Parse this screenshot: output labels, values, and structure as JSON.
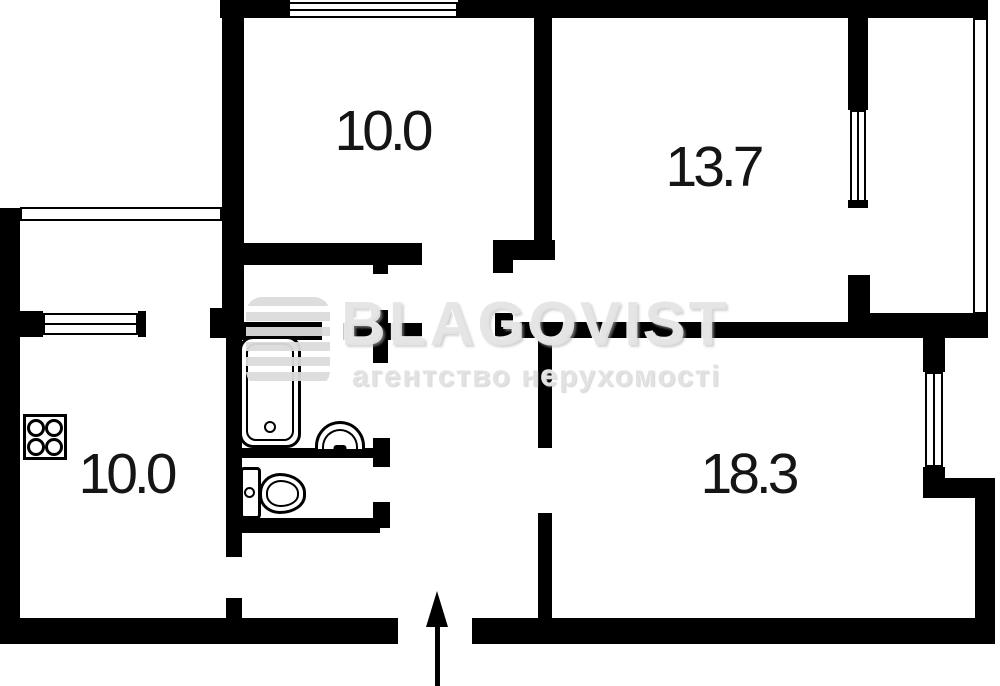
{
  "watermark": {
    "title": "BLAGOVIST",
    "subtitle": "агентство нерухомості",
    "color": "#e4e4e4"
  },
  "room_labels": [
    {
      "id": "top-left-room",
      "text": "10.0",
      "cx": 382,
      "cy": 131
    },
    {
      "id": "top-right-room",
      "text": "13.7",
      "cx": 713,
      "cy": 167
    },
    {
      "id": "kitchen",
      "text": "10.0",
      "cx": 126,
      "cy": 474
    },
    {
      "id": "bottom-right-room",
      "text": "18.3",
      "cx": 748,
      "cy": 474
    }
  ],
  "wall_color": "#000000",
  "walls": [
    {
      "x": 220,
      "y": 0,
      "w": 70,
      "h": 18
    },
    {
      "x": 458,
      "y": 0,
      "w": 530,
      "h": 18
    },
    {
      "x": 222,
      "y": 18,
      "w": 22,
      "h": 292
    },
    {
      "x": 210,
      "y": 308,
      "w": 34,
      "h": 30
    },
    {
      "x": 534,
      "y": 18,
      "w": 18,
      "h": 240
    },
    {
      "x": 244,
      "y": 243,
      "w": 178,
      "h": 22
    },
    {
      "x": 493,
      "y": 240,
      "w": 62,
      "h": 20
    },
    {
      "x": 493,
      "y": 240,
      "w": 20,
      "h": 33
    },
    {
      "x": 848,
      "y": 18,
      "w": 20,
      "h": 92
    },
    {
      "x": 848,
      "y": 200,
      "w": 20,
      "h": 8
    },
    {
      "x": 848,
      "y": 275,
      "w": 22,
      "h": 63
    },
    {
      "x": 495,
      "y": 313,
      "w": 18,
      "h": 25
    },
    {
      "x": 495,
      "y": 322,
      "w": 353,
      "h": 16
    },
    {
      "x": 848,
      "y": 313,
      "w": 140,
      "h": 25
    },
    {
      "x": 538,
      "y": 338,
      "w": 14,
      "h": 110
    },
    {
      "x": 538,
      "y": 513,
      "w": 14,
      "h": 110
    },
    {
      "x": 923,
      "y": 338,
      "w": 22,
      "h": 34
    },
    {
      "x": 923,
      "y": 467,
      "w": 22,
      "h": 31
    },
    {
      "x": 923,
      "y": 478,
      "w": 72,
      "h": 20
    },
    {
      "x": 975,
      "y": 490,
      "w": 20,
      "h": 154
    },
    {
      "x": 0,
      "y": 618,
      "w": 398,
      "h": 26
    },
    {
      "x": 472,
      "y": 618,
      "w": 523,
      "h": 26
    },
    {
      "x": 0,
      "y": 208,
      "w": 20,
      "h": 436
    },
    {
      "x": 20,
      "y": 311,
      "w": 23,
      "h": 26
    },
    {
      "x": 138,
      "y": 311,
      "w": 8,
      "h": 26
    },
    {
      "x": 226,
      "y": 334,
      "w": 16,
      "h": 223
    },
    {
      "x": 226,
      "y": 598,
      "w": 16,
      "h": 22
    },
    {
      "x": 226,
      "y": 322,
      "w": 96,
      "h": 18
    },
    {
      "x": 343,
      "y": 323,
      "w": 79,
      "h": 17
    },
    {
      "x": 373,
      "y": 310,
      "w": 15,
      "h": 53
    },
    {
      "x": 373,
      "y": 265,
      "w": 15,
      "h": 9
    },
    {
      "x": 242,
      "y": 448,
      "w": 131,
      "h": 10
    },
    {
      "x": 373,
      "y": 438,
      "w": 17,
      "h": 29
    },
    {
      "x": 373,
      "y": 502,
      "w": 17,
      "h": 26
    },
    {
      "x": 238,
      "y": 518,
      "w": 142,
      "h": 15
    }
  ],
  "windows": [
    {
      "x": 288,
      "y": 2,
      "w": 170,
      "h": 16,
      "orient": "h",
      "mid": true
    },
    {
      "x": 20,
      "y": 207,
      "w": 202,
      "h": 14,
      "orient": "h",
      "mid": false
    },
    {
      "x": 43,
      "y": 313,
      "w": 95,
      "h": 22,
      "orient": "h",
      "mid": true
    },
    {
      "x": 850,
      "y": 110,
      "w": 16,
      "h": 92,
      "orient": "v",
      "mid": true
    },
    {
      "x": 925,
      "y": 372,
      "w": 18,
      "h": 95,
      "orient": "v",
      "mid": true
    },
    {
      "x": 973,
      "y": 18,
      "w": 15,
      "h": 296,
      "orient": "v",
      "mid": false
    }
  ],
  "fixtures": {
    "stove": {
      "x": 23,
      "y": 414,
      "w": 44,
      "h": 46
    },
    "bathtub": {
      "x": 239,
      "y": 336,
      "w": 62,
      "h": 112
    },
    "sink": {
      "x": 315,
      "y": 421,
      "w": 50,
      "h": 28
    },
    "toilet_tank": {
      "x": 240,
      "y": 467,
      "w": 21,
      "h": 52
    },
    "toilet_dot": {
      "x": 244,
      "y": 487
    },
    "toilet_bowl": {
      "x": 259,
      "y": 473,
      "w": 47,
      "h": 41
    }
  },
  "entrance_arrow": {
    "tip_x": 437,
    "tip_y": 591,
    "head_w": 22,
    "head_h": 36,
    "shaft_w": 5,
    "bottom": 686
  }
}
